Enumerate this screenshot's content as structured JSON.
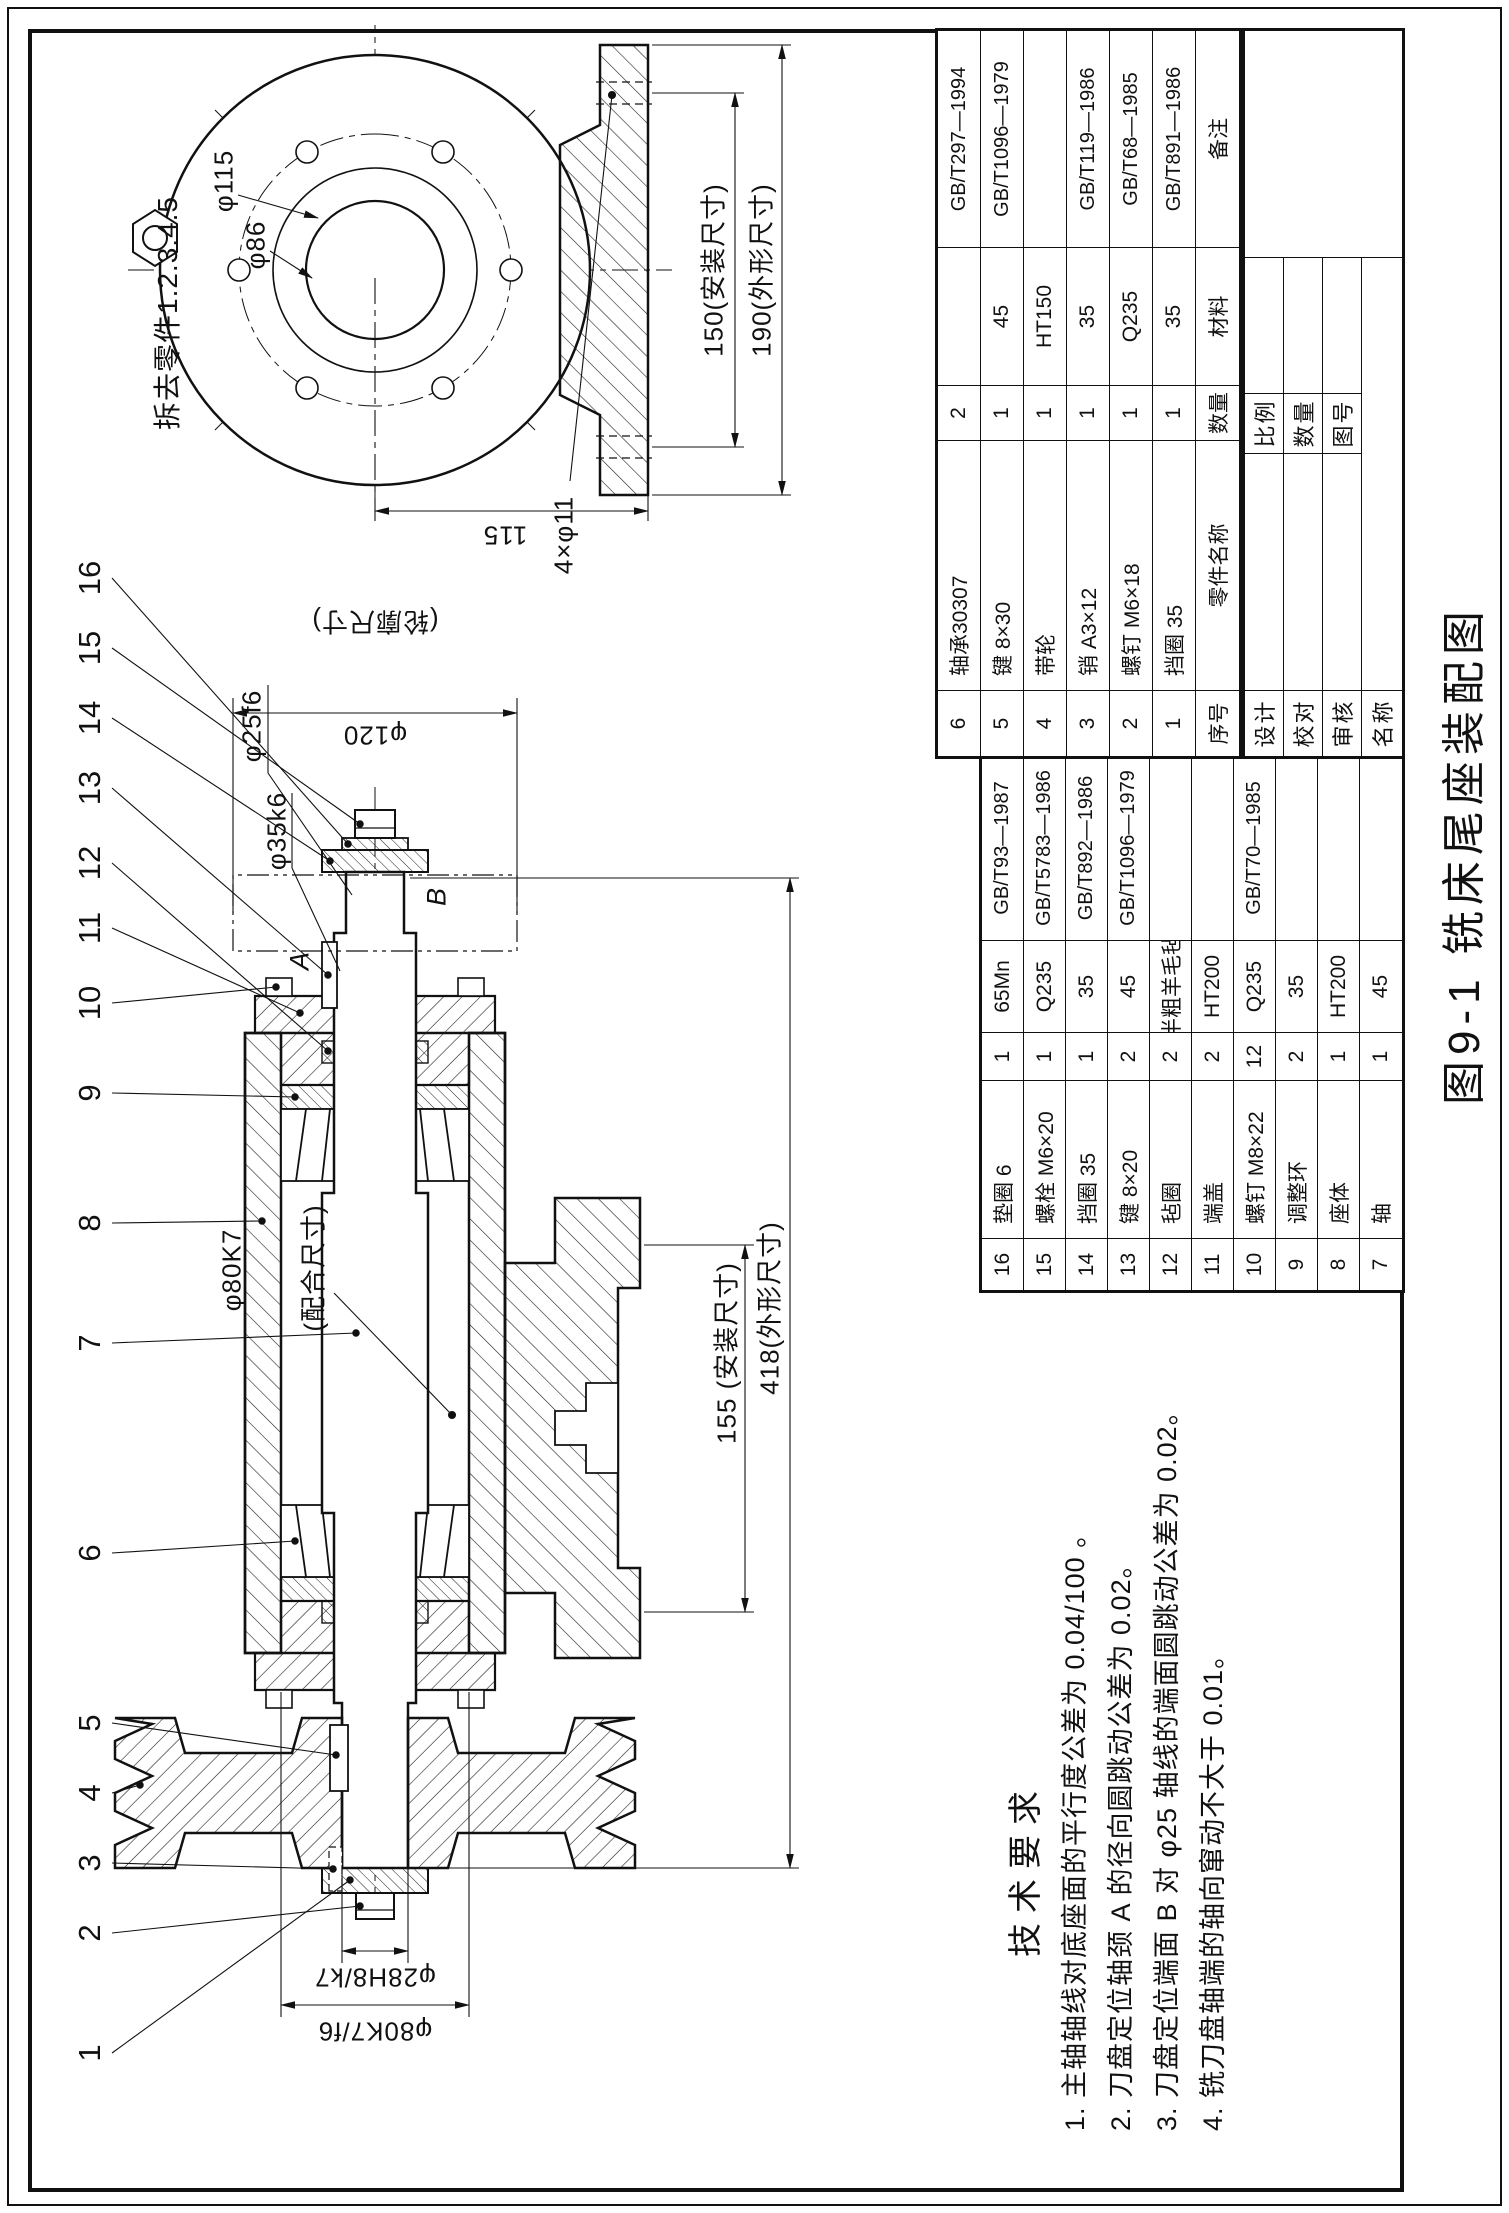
{
  "figure": {
    "caption": "图9-1  铣床尾座装配图"
  },
  "detail_view": {
    "note": "拆去零件1.2.3.4.5",
    "dims": {
      "d150": "150(安装尺寸)",
      "d190": "190(外形尺寸)",
      "d115_height": "115",
      "d4xphi11": "4×φ11",
      "dphi115": "φ115",
      "dphi86": "φ86"
    }
  },
  "main_view": {
    "dims": {
      "dphi120": "φ120",
      "dlunkuo": "(轮廓尺寸)",
      "dphi25": "φ25f6",
      "dphi35": "φ35k6",
      "dphi80k7": "φ80K7",
      "dpeihe": "(配合尺寸)",
      "dphi28": "φ28H8/k7",
      "dphi80f6": "φ80K7/f6",
      "d155": "155 (安装尺寸)",
      "d418": "418(外形尺寸)"
    },
    "datums": {
      "a": "A",
      "b": "B"
    }
  },
  "balloons": [
    "1",
    "2",
    "3",
    "4",
    "5",
    "6",
    "7",
    "8",
    "9",
    "10",
    "11",
    "12",
    "13",
    "14",
    "15",
    "16"
  ],
  "tech": {
    "title": "技术要求",
    "items": [
      "1. 主轴轴线对底座面的平行度公差为 0.04/100 。",
      "2. 刀盘定位轴颈 A 的径向圆跳动公差为 0.02。",
      "3. 刀盘定位端面 B 对 φ25 轴线的端面圆跳动公差为 0.02。",
      "4. 铣刀盘轴端的轴向窜动不大于 0.01。"
    ]
  },
  "bom_lower": {
    "header": [
      "序号",
      "零件名称",
      "数量",
      "材料",
      "备注"
    ],
    "rows": [
      {
        "no": "6",
        "name": "轴承30307",
        "qty": "2",
        "mat": "",
        "rem": "GB/T297—1994"
      },
      {
        "no": "5",
        "name": "键 8×30",
        "qty": "1",
        "mat": "45",
        "rem": "GB/T1096—1979"
      },
      {
        "no": "4",
        "name": "带轮",
        "qty": "1",
        "mat": "HT150",
        "rem": ""
      },
      {
        "no": "3",
        "name": "销 A3×12",
        "qty": "1",
        "mat": "35",
        "rem": "GB/T119—1986"
      },
      {
        "no": "2",
        "name": "螺钉 M6×18",
        "qty": "1",
        "mat": "Q235",
        "rem": "GB/T68—1985"
      },
      {
        "no": "1",
        "name": "挡圈 35",
        "qty": "1",
        "mat": "35",
        "rem": "GB/T891—1986"
      }
    ]
  },
  "bom_upper": {
    "rows": [
      {
        "no": "16",
        "name": "垫圈 6",
        "qty": "1",
        "mat": "65Mn",
        "rem": "GB/T93—1987"
      },
      {
        "no": "15",
        "name": "螺栓 M6×20",
        "qty": "1",
        "mat": "Q235",
        "rem": "GB/T5783—1986"
      },
      {
        "no": "14",
        "name": "挡圈 35",
        "qty": "1",
        "mat": "35",
        "rem": "GB/T892—1986"
      },
      {
        "no": "13",
        "name": "键 8×20",
        "qty": "2",
        "mat": "45",
        "rem": "GB/T1096—1979"
      },
      {
        "no": "12",
        "name": "毡圈",
        "qty": "2",
        "mat": "半粗羊毛毡",
        "rem": ""
      },
      {
        "no": "11",
        "name": "端盖",
        "qty": "2",
        "mat": "HT200",
        "rem": ""
      },
      {
        "no": "10",
        "name": "螺钉 M8×22",
        "qty": "12",
        "mat": "Q235",
        "rem": "GB/T70—1985"
      },
      {
        "no": "9",
        "name": "调整环",
        "qty": "2",
        "mat": "35",
        "rem": ""
      },
      {
        "no": "8",
        "name": "座体",
        "qty": "1",
        "mat": "HT200",
        "rem": ""
      },
      {
        "no": "7",
        "name": "轴",
        "qty": "1",
        "mat": "45",
        "rem": ""
      }
    ]
  },
  "title_block": {
    "design": "设计",
    "check": "校对",
    "audit": "审核",
    "name": "名称",
    "scale": "比例",
    "quantity": "数量",
    "dwg_no": "图号"
  }
}
